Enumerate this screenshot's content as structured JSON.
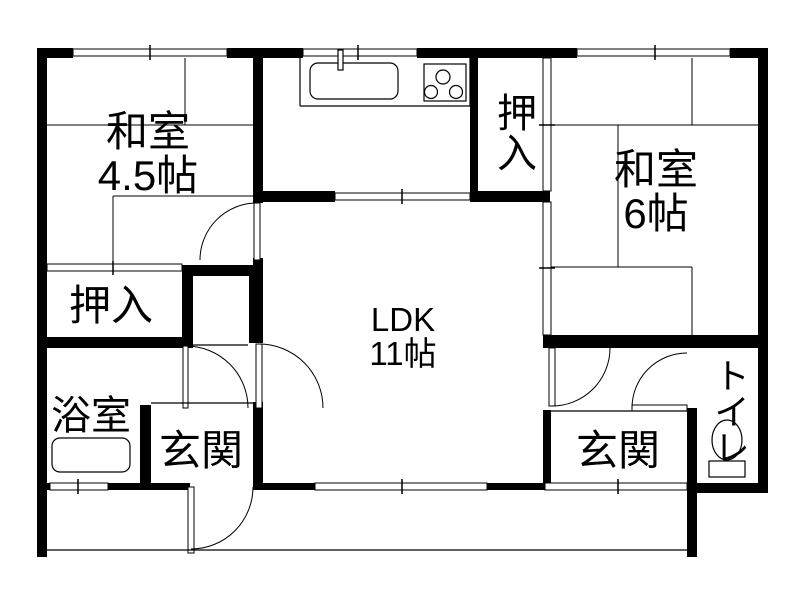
{
  "page": {
    "background": "#ffffff",
    "wall_color": "#000000",
    "line_color": "#000000"
  },
  "rooms": {
    "washitsu_45": {
      "name": "和室",
      "size": "4.5帖"
    },
    "oshiire_top": {
      "name": "押入"
    },
    "washitsu_6": {
      "name": "和室",
      "size": "6帖"
    },
    "ldk": {
      "name": "LDK",
      "size": "11帖"
    },
    "oshiire_left": {
      "name": "押入"
    },
    "bathroom": {
      "name": "浴室"
    },
    "genkan_left": {
      "name": "玄関"
    },
    "genkan_right": {
      "name": "玄関"
    },
    "toilet": {
      "name": "トイレ"
    }
  },
  "fixtures": {
    "sink": "kitchen-sink",
    "stove": "gas-stove",
    "bathtub": "bathtub",
    "toilet_bowl": "toilet"
  }
}
